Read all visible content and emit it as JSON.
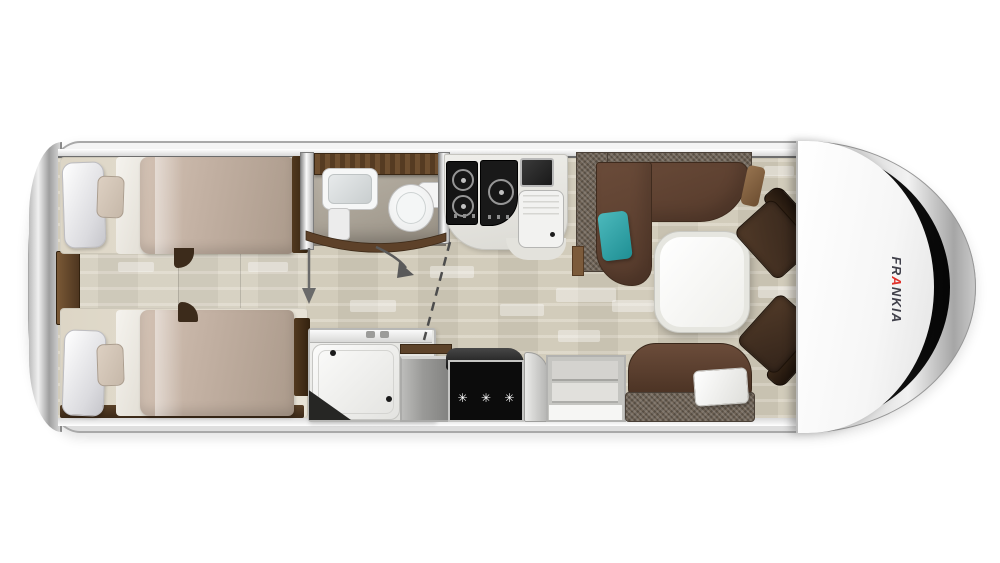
{
  "brand": {
    "prefix": "FR",
    "accent_letter": "A",
    "suffix": "NKIA",
    "accent_color": "#e0312a",
    "text_color": "#41414b"
  },
  "fridge": {
    "freezer_stars": "✳ ✳ ✳"
  },
  "icons": {
    "sliding_door_arrow": "down-arrow-icon",
    "door_swing_arrow": "curved-arrow-icon",
    "entry_path_line": "dashed-line",
    "freezer_rating": "snowflake-stars-icon"
  },
  "colors": {
    "floor": "#d6cfbd",
    "sofa_brown": "#5d4233",
    "sofa_tweed": "#6d6154",
    "accent_teal": "#2fa3a8",
    "duvet_beige": "#c3b1a3",
    "wood_trim": "#5d432a",
    "appliance_black": "#0c0c0c",
    "body_silver": "#e5e5e5"
  }
}
